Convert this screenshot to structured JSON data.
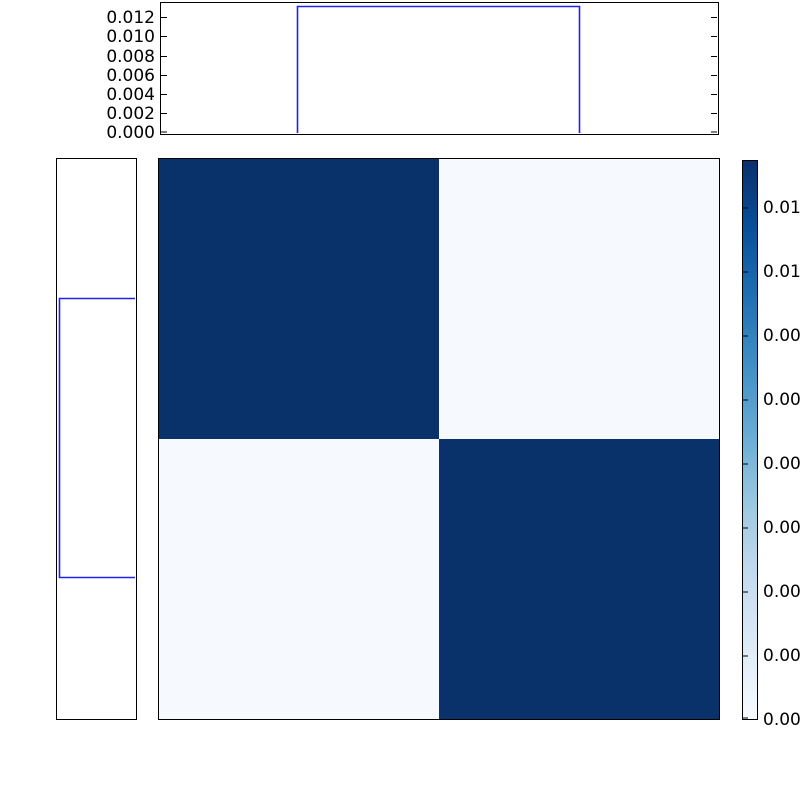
{
  "figure": {
    "background": "#ffffff",
    "description": "Joint 2x2 heatmap (Blues colormap) with uniform marginal step-histograms on top and left, and a colorbar on the right; colorbar tick labels are clipped by the right image edge."
  },
  "top_hist": {
    "ytick_labels": [
      "0.012",
      "0.010",
      "0.008",
      "0.006",
      "0.004",
      "0.002",
      "0.000"
    ],
    "line_color": "#2222ee"
  },
  "left_hist": {
    "line_color": "#2222ee"
  },
  "heatmap": {
    "cell_colors": {
      "top_left": "#0a326a",
      "top_right": "#f6f9fd",
      "bottom_left": "#f6f9fd",
      "bottom_right": "#0a326a"
    }
  },
  "colorbar": {
    "tick_labels": [
      "0.0120",
      "0.0105",
      "0.0090",
      "0.0075",
      "0.0060",
      "0.0045",
      "0.0030",
      "0.0015",
      "0.0000"
    ],
    "colormap": "Blues",
    "max_color": "#08306b",
    "min_color": "#f7fbff"
  },
  "chart_data": [
    {
      "type": "heatmap",
      "title": "",
      "xlabel": "",
      "ylabel": "",
      "rows": 2,
      "cols": 2,
      "matrix": [
        [
          0.0131,
          0.0003
        ],
        [
          0.0003,
          0.0131
        ]
      ],
      "colormap": "Blues",
      "vmin": 0.0,
      "vmax": 0.0131,
      "xtick_labels": [],
      "ytick_labels": [],
      "colorbar": {
        "position": "right",
        "ticks": [
          0.0,
          0.0015,
          0.003,
          0.0045,
          0.006,
          0.0075,
          0.009,
          0.0105,
          0.012
        ],
        "tick_labels_visible_truncated": [
          "0.00",
          "0.00",
          "0.00",
          "0.00",
          "0.00",
          "0.00",
          "0.00",
          "0.01",
          "0.01"
        ],
        "gradient_stops": [
          "#08306b",
          "#08519c",
          "#2171b5",
          "#4292c6",
          "#6baed6",
          "#9ecae1",
          "#c6dbef",
          "#deebf7",
          "#f7fbff"
        ]
      }
    },
    {
      "type": "line",
      "name": "top-marginal-uniform-step",
      "x": [
        0.0,
        0.25,
        0.25,
        0.75,
        0.75,
        1.0
      ],
      "y": [
        0.0,
        0.0,
        0.0131,
        0.0131,
        0.0,
        0.0
      ],
      "xlim": [
        0.0,
        1.0
      ],
      "ylim": [
        0.0,
        0.0136
      ],
      "yticks": [
        0.0,
        0.002,
        0.004,
        0.006,
        0.008,
        0.01,
        0.012
      ],
      "ytick_labels": [
        "0.000",
        "0.002",
        "0.004",
        "0.006",
        "0.008",
        "0.010",
        "0.012"
      ],
      "line_color_nominal": "#0000ff",
      "grid": false,
      "legend": null
    },
    {
      "type": "line",
      "name": "left-marginal-uniform-step",
      "orientation": "horizontal",
      "x_axis_inverted": true,
      "y": [
        0.0,
        0.25,
        0.25,
        0.75,
        0.75,
        1.0
      ],
      "x": [
        0.0,
        0.0,
        0.0131,
        0.0131,
        0.0,
        0.0
      ],
      "xlim": [
        0.0136,
        0.0
      ],
      "ylim": [
        0.0,
        1.0
      ],
      "tick_labels": [],
      "line_color_nominal": "#0000ff",
      "grid": false,
      "legend": null
    }
  ]
}
